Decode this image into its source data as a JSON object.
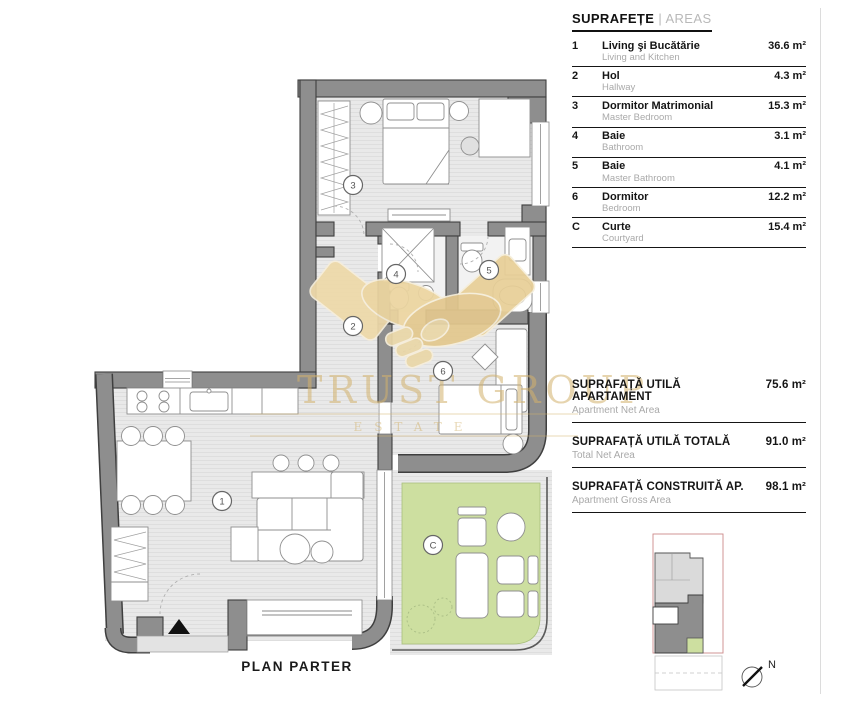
{
  "legend": {
    "title_ro": "SUPRAFEȚE",
    "title_sep": "|",
    "title_en": "AREAS",
    "rows": [
      {
        "num": "1",
        "name": "Living şi Bucătărie",
        "sub": "Living and Kitchen",
        "area": "36.6 m²"
      },
      {
        "num": "2",
        "name": "Hol",
        "sub": "Hallway",
        "area": "4.3 m²"
      },
      {
        "num": "3",
        "name": "Dormitor Matrimonial",
        "sub": "Master Bedroom",
        "area": "15.3 m²"
      },
      {
        "num": "4",
        "name": "Baie",
        "sub": "Bathroom",
        "area": "3.1 m²"
      },
      {
        "num": "5",
        "name": "Baie",
        "sub": "Master Bathroom",
        "area": "4.1 m²"
      },
      {
        "num": "6",
        "name": "Dormitor",
        "sub": "Bedroom",
        "area": "12.2 m²"
      },
      {
        "num": "C",
        "name": "Curte",
        "sub": "Courtyard",
        "area": "15.4 m²"
      }
    ],
    "totals": [
      {
        "name": "SUPRAFAȚĂ UTILĂ APARTAMENT",
        "sub": "Apartment Net Area",
        "area": "75.6 m²"
      },
      {
        "name": "SUPRAFAȚĂ UTILĂ TOTALĂ",
        "sub": "Total Net Area",
        "area": "91.0 m²"
      },
      {
        "name": "SUPRAFAȚĂ CONSTRUITĂ AP.",
        "sub": "Apartment Gross Area",
        "area": "98.1 m²"
      }
    ]
  },
  "plan": {
    "title": "PLAN PARTER",
    "north": "N",
    "room_labels": [
      "1",
      "2",
      "3",
      "4",
      "5",
      "6",
      "C"
    ]
  },
  "watermark": {
    "line1": "TRUST GROUP",
    "line2": "ESTATE"
  },
  "colors": {
    "wall": "#8e8e8e",
    "wall_outline": "#3f3f3f",
    "floor": "#e9e9e9",
    "courtyard_green": "#cddfa0",
    "watermark_gold": "#d3b26c",
    "minimap_boundary_red": "#cc8a8a"
  }
}
